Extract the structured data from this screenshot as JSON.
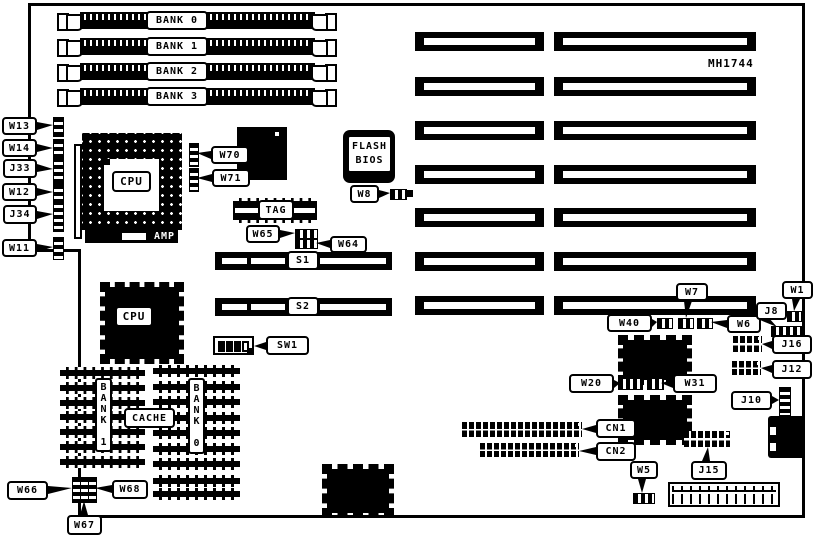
{
  "diagram": {
    "part_number": "MH1744",
    "memory_banks": [
      {
        "label": "BANK 0"
      },
      {
        "label": "BANK 1"
      },
      {
        "label": "BANK 2"
      },
      {
        "label": "BANK 3"
      }
    ],
    "slots": {
      "s1": "S1",
      "s2": "S2"
    },
    "chips": {
      "cpu_socket": "CPU",
      "cpu_socket_brand": "AMP",
      "cpu_qfp": "CPU",
      "flash_bios_line1": "FLASH",
      "flash_bios_line2": "BIOS",
      "tag": "TAG",
      "cache": "CACHE",
      "cache_bank_left": "BANK 1",
      "cache_bank_right": "BANK 0"
    },
    "callouts": {
      "w13": "W13",
      "w14": "W14",
      "j33": "J33",
      "w12": "W12",
      "j34": "J34",
      "w11": "W11",
      "w70": "W70",
      "w71": "W71",
      "w8": "W8",
      "w65": "W65",
      "w64": "W64",
      "sw1": "SW1",
      "w66": "W66",
      "w67": "W67",
      "w68": "W68",
      "w40": "W40",
      "w7": "W7",
      "w6": "W6",
      "w1": "W1",
      "j8": "J8",
      "j16": "J16",
      "j12": "J12",
      "j10": "J10",
      "w20": "W20",
      "w31": "W31",
      "cn1": "CN1",
      "cn2": "CN2",
      "w5": "W5",
      "j15": "J15"
    }
  }
}
